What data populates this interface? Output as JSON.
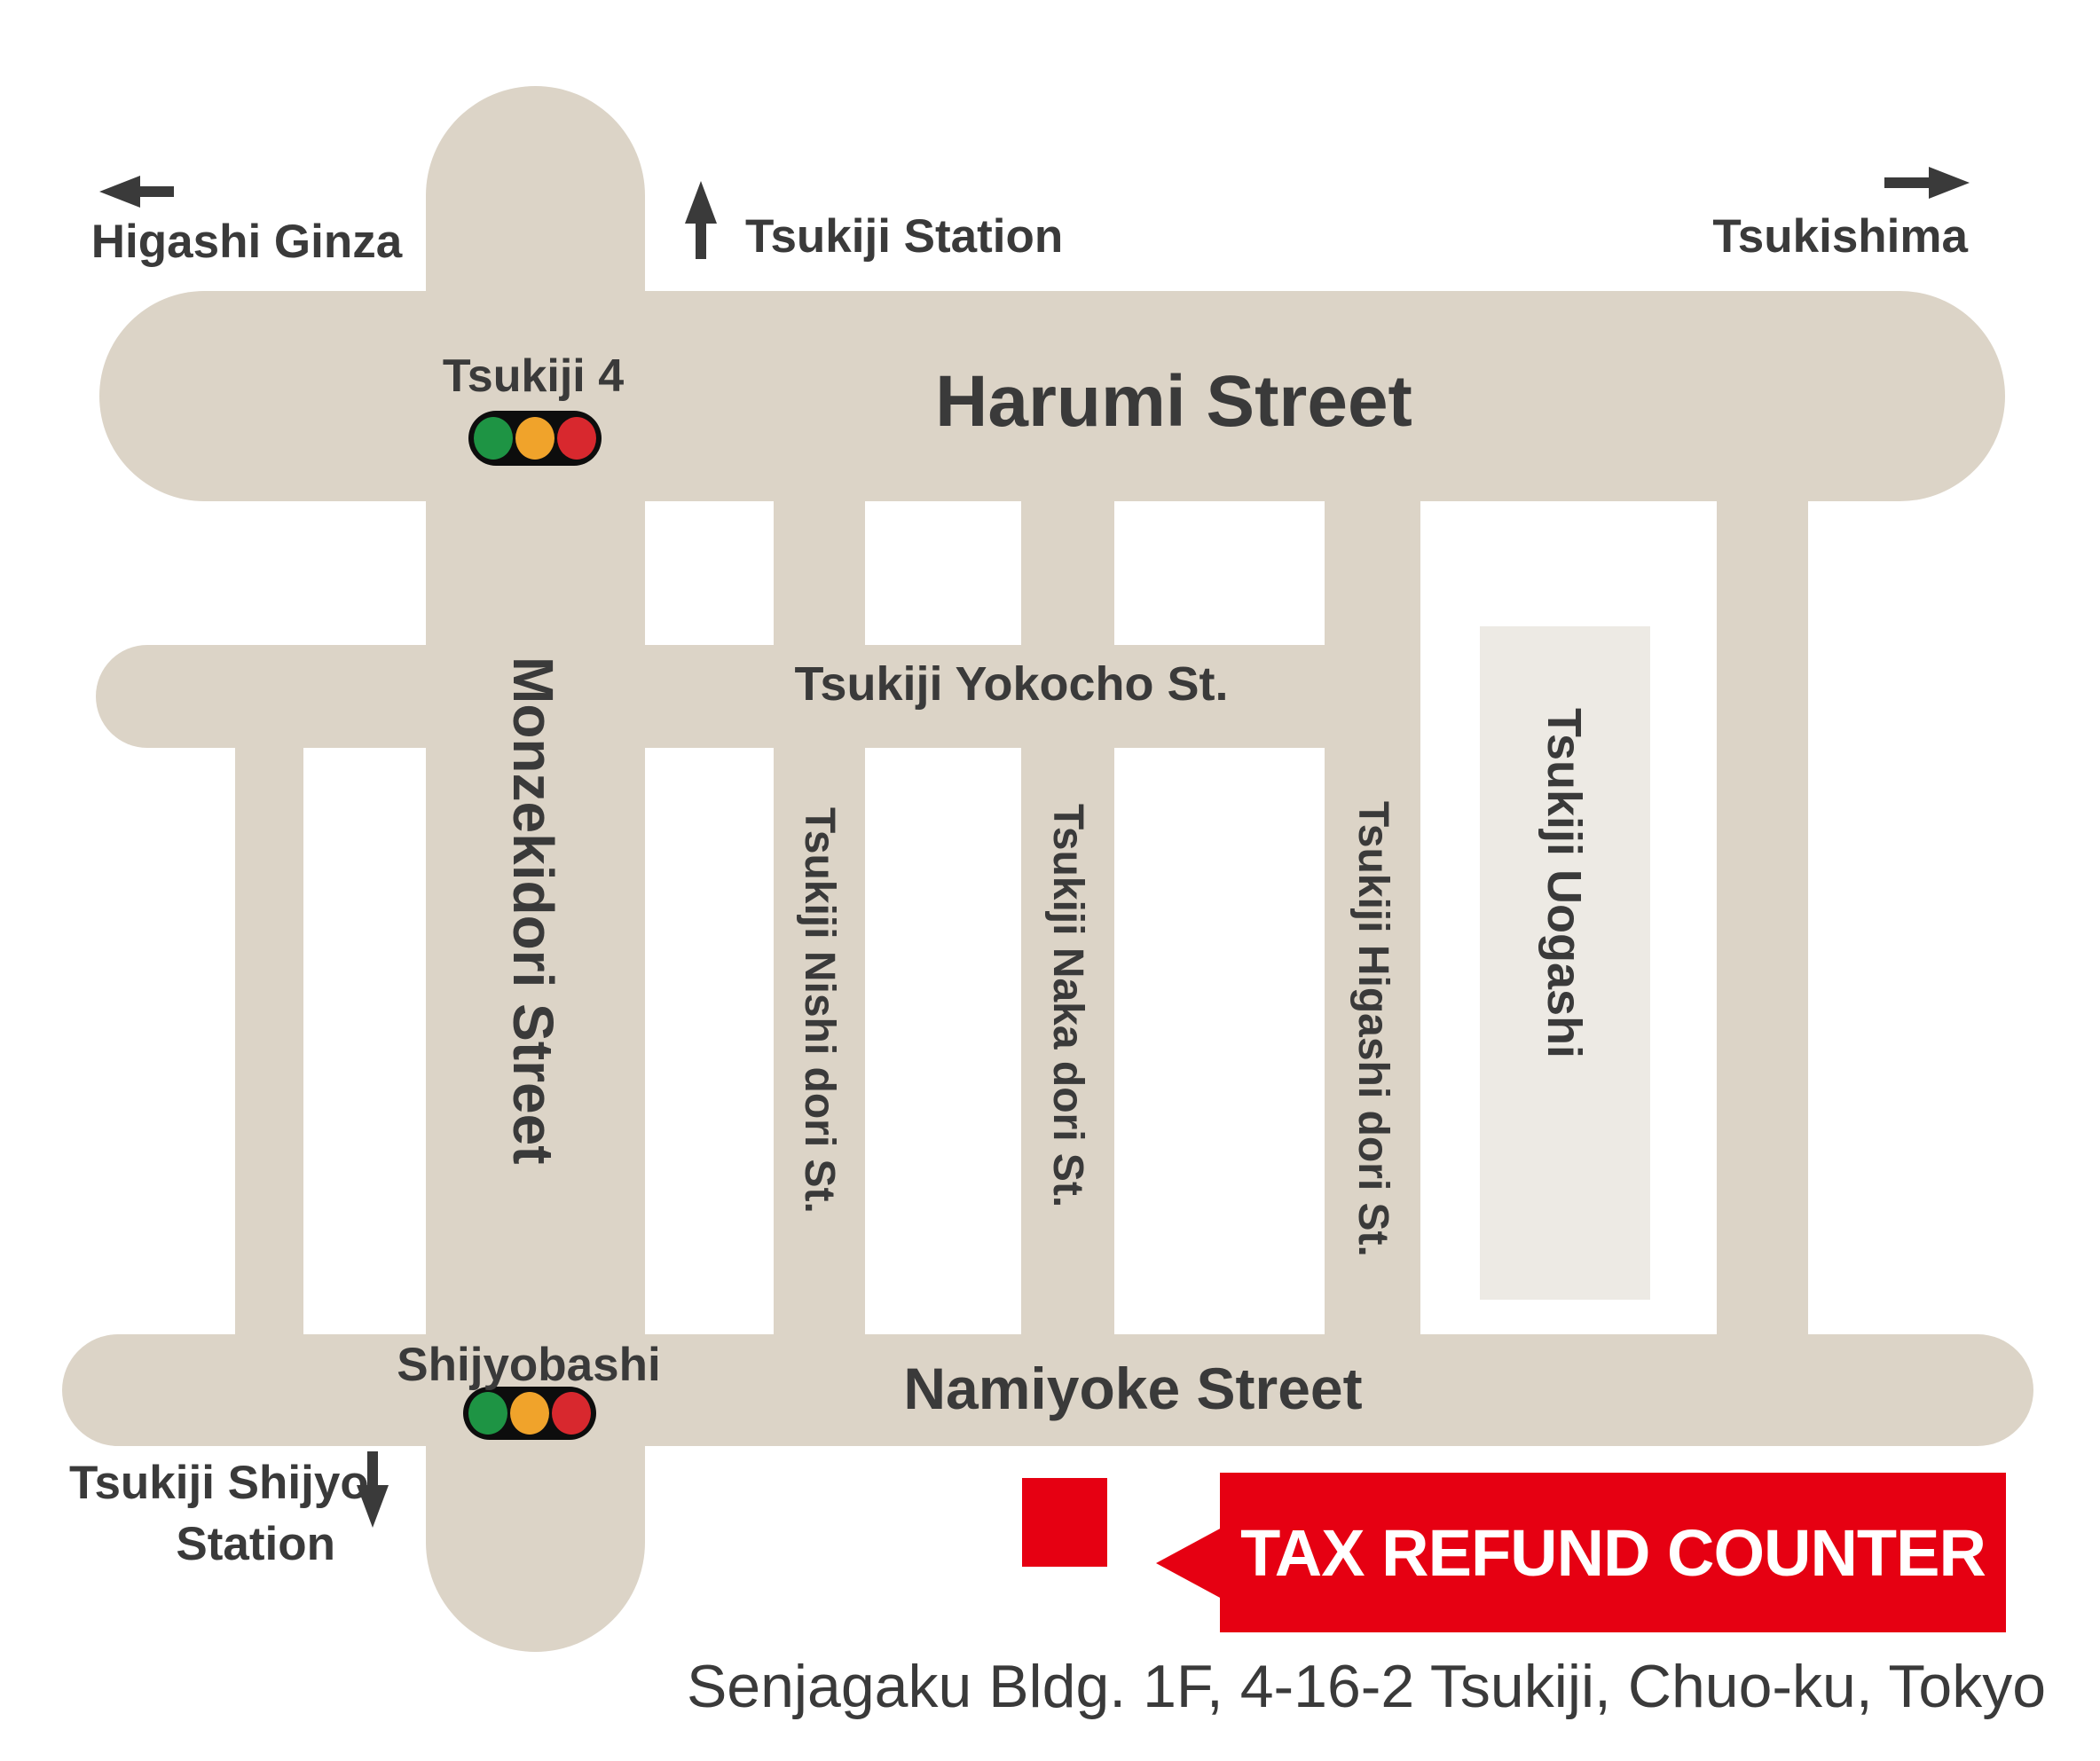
{
  "map": {
    "directions": {
      "higashi_ginza": "Higashi Ginza",
      "tsukiji_station": "Tsukiji Station",
      "tsukishima": "Tsukishima",
      "tsukiji_shijyo_line1": "Tsukiji Shijyo",
      "tsukiji_shijyo_line2": "Station"
    },
    "streets": {
      "harumi": "Harumi Street",
      "monzekidori": "Monzekidori Street",
      "yokocho": "Tsukiji Yokocho St.",
      "nishi": "Tsukiji Nishi dori St.",
      "naka": "Tsukiji Naka dori St.",
      "higashi": "Tsukiji Higashi dori St.",
      "namiyoke": "Namiyoke Street",
      "uogashi": "Tsukiji Uogashi"
    },
    "intersections": {
      "tsukiji4": "Tsukiji 4",
      "shijyobashi": "Shijyobashi"
    },
    "poi": {
      "tax_refund_counter": "TAX REFUND COUNTER"
    },
    "address": "Senjagaku Bldg. 1F, 4-16-2 Tsukiji, Chuo-ku, Tokyo",
    "icons": {
      "left_arrow": "left-arrow-icon",
      "up_arrow": "up-arrow-icon",
      "right_arrow": "right-arrow-icon",
      "down_arrow": "down-arrow-icon",
      "traffic_light": "traffic-light-icon"
    },
    "colors": {
      "road": "#dcd4c7",
      "uogashi_block": "#edeae4",
      "text": "#3a3a3a",
      "accent_red": "#e60012",
      "signal_green": "#1e9444",
      "signal_amber": "#f0a32b",
      "signal_red": "#d8282e",
      "background": "#ffffff"
    }
  }
}
